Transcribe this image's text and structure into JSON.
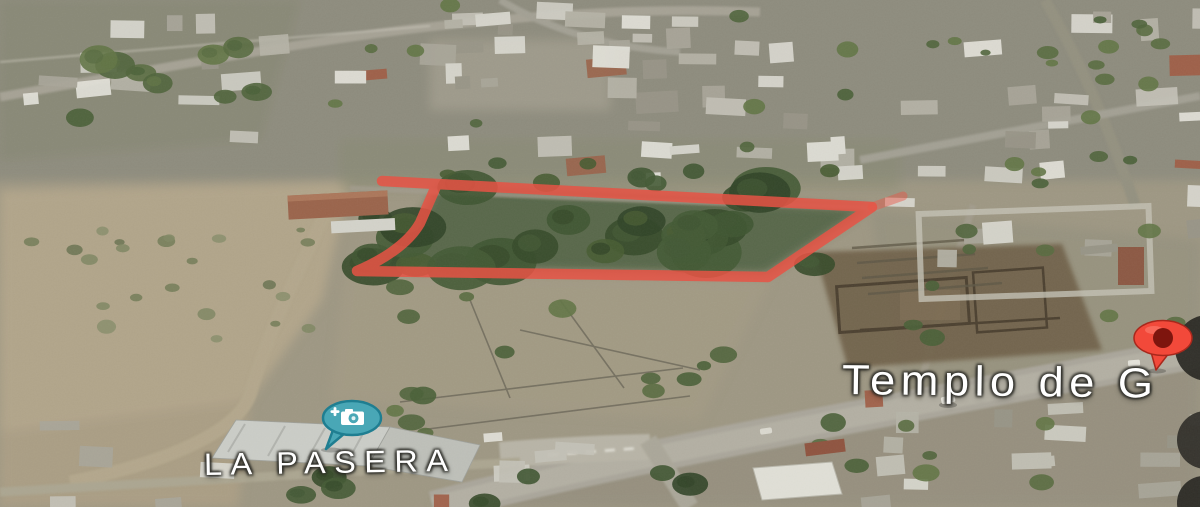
{
  "map": {
    "view": "satellite",
    "labels": {
      "business": "LA PASERA",
      "landmark": "Templo de G"
    },
    "markers": {
      "photo_pin": {
        "icon": "camera-icon",
        "fill": "#49a7b6",
        "border": "#1f7e91",
        "glyph_color": "#ffffff"
      },
      "place_pin": {
        "icon": "map-pin-icon",
        "fill": "#f2493a",
        "border": "#a8281c",
        "center_dot": "#7e150e"
      }
    },
    "boundary": {
      "color": "#e85445",
      "opacity": "0.85",
      "stroke_width": "10.5",
      "path": "M382,181 L437,184 L872,207 L768,277 L357,271 C378,262 407,246 420,223 L437,184",
      "tick_path": "M872,207 L903,196",
      "tick_opacity": "0.45"
    }
  }
}
